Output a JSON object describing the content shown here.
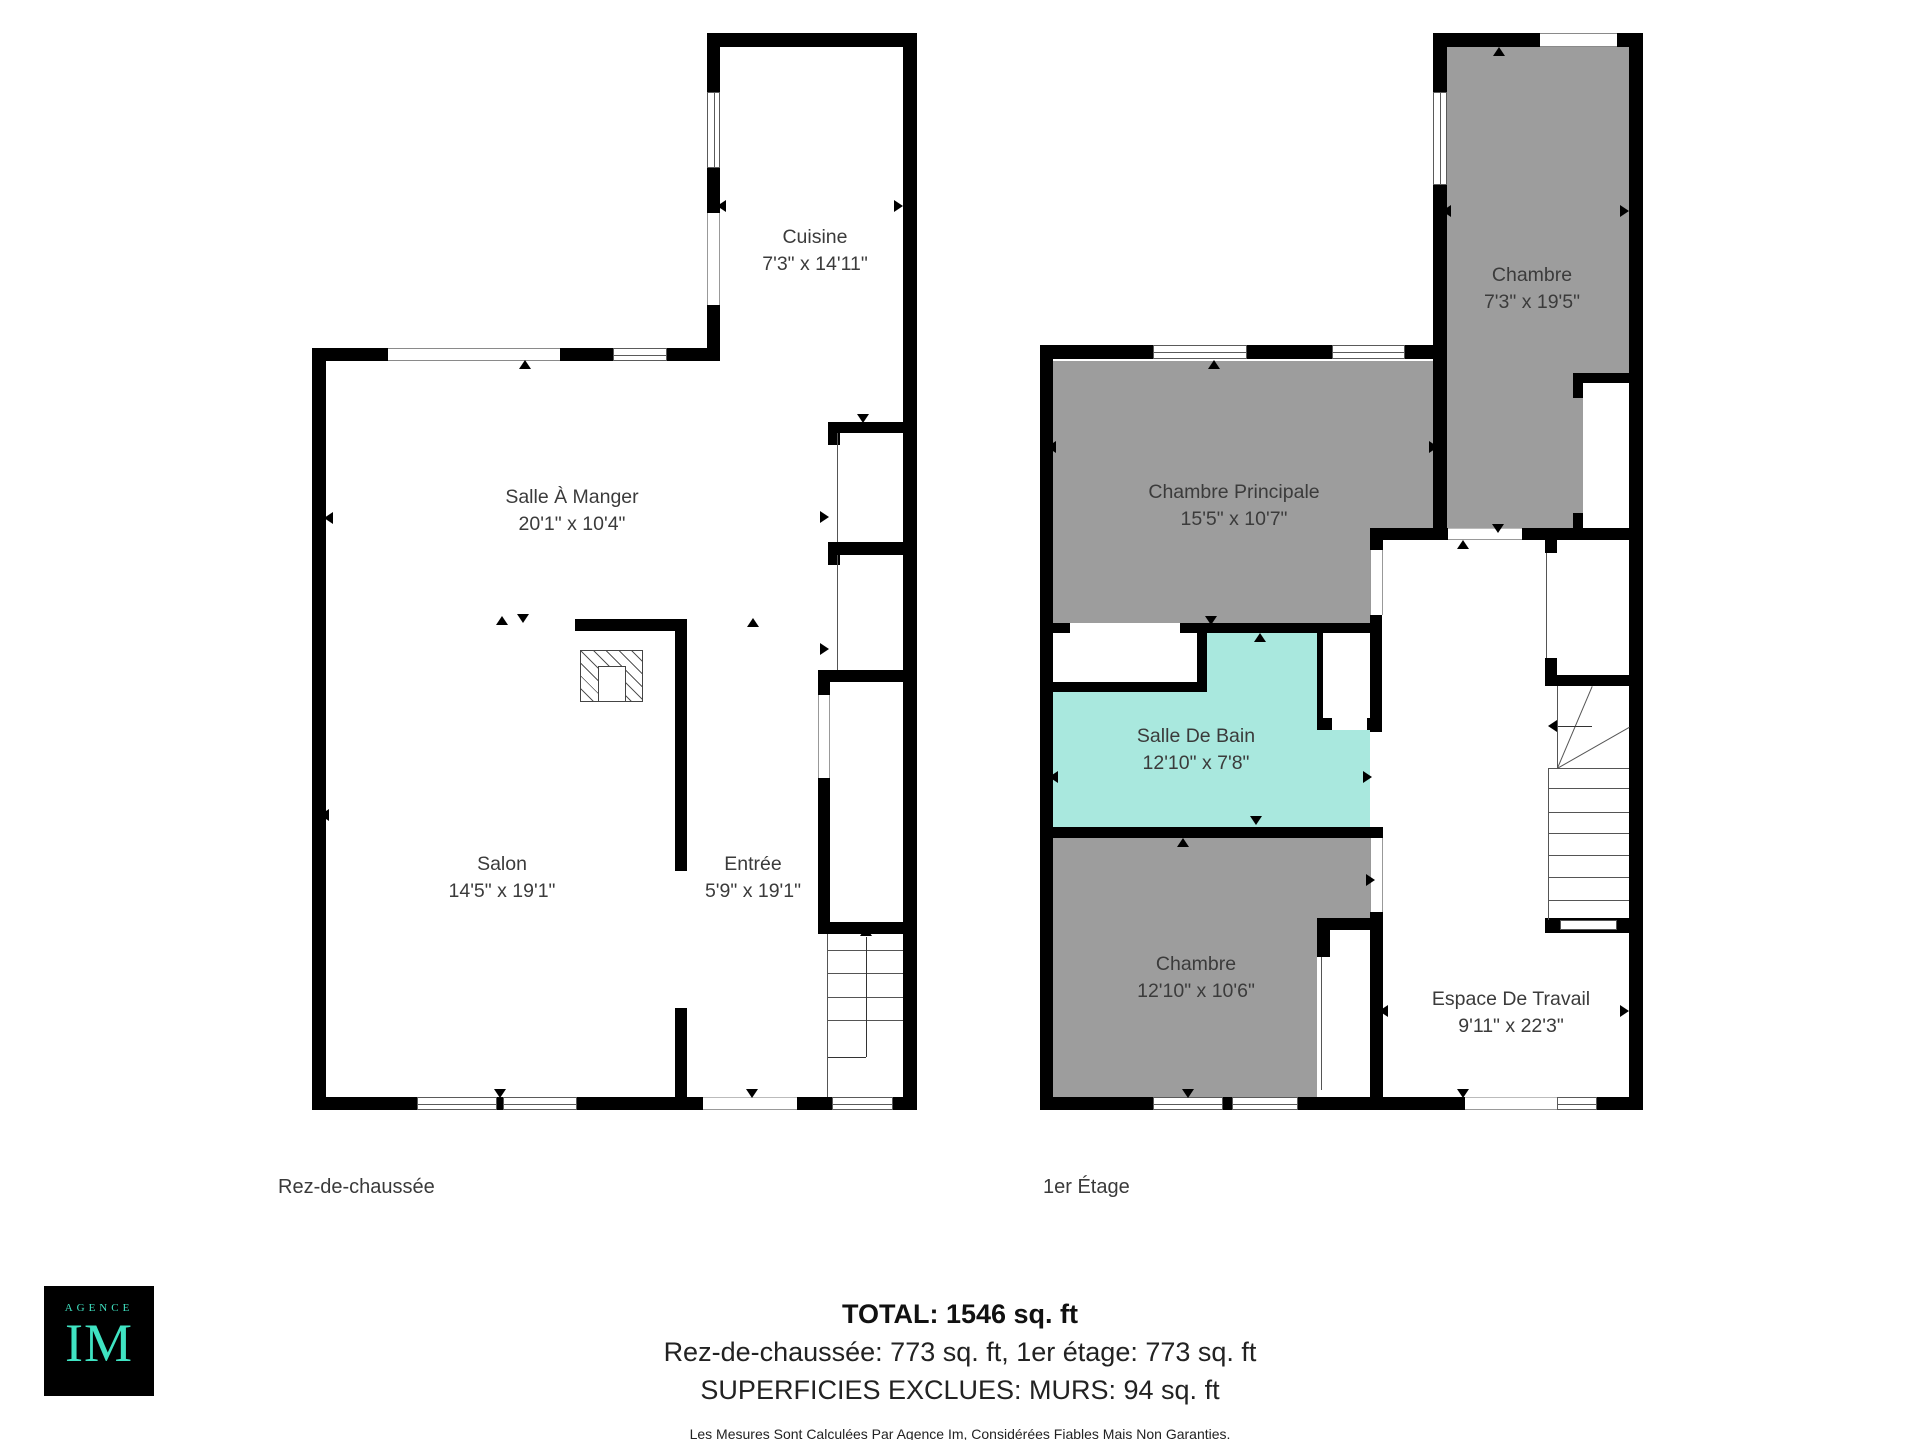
{
  "floors": [
    {
      "label": "Rez-de-chaussée",
      "rooms": [
        {
          "name": "Cuisine",
          "dims": "7'3\" x 14'11\""
        },
        {
          "name": "Salle À Manger",
          "dims": "20'1\" x 10'4\""
        },
        {
          "name": "Salon",
          "dims": "14'5\" x 19'1\""
        },
        {
          "name": "Entrée",
          "dims": "5'9\" x 19'1\""
        }
      ]
    },
    {
      "label": "1er Étage",
      "rooms": [
        {
          "name": "Chambre",
          "dims": "7'3\" x 19'5\""
        },
        {
          "name": "Chambre Principale",
          "dims": "15'5\" x 10'7\""
        },
        {
          "name": "Salle De Bain",
          "dims": "12'10\" x 7'8\""
        },
        {
          "name": "Chambre",
          "dims": "12'10\" x 10'6\""
        },
        {
          "name": "Espace De Travail",
          "dims": "9'11\" x 22'3\""
        }
      ]
    }
  ],
  "footer": {
    "total": "TOTAL: 1546 sq. ft",
    "breakdown": "Rez-de-chaussée: 773 sq. ft, 1er étage: 773 sq. ft",
    "excluded": "SUPERFICIES EXCLUES: MURS: 94 sq. ft",
    "disclaimer": "Les Mesures Sont Calculées Par Agence Im, Considérées Fiables Mais Non Garanties."
  },
  "logo": {
    "top": "AGENCE",
    "main": "IM"
  },
  "colors": {
    "wall": "#000000",
    "room_gray": "#9d9d9d",
    "bathroom_teal": "#a9e8de",
    "logo_teal": "#3fe3c2",
    "label_text": "#3b3b3b"
  }
}
